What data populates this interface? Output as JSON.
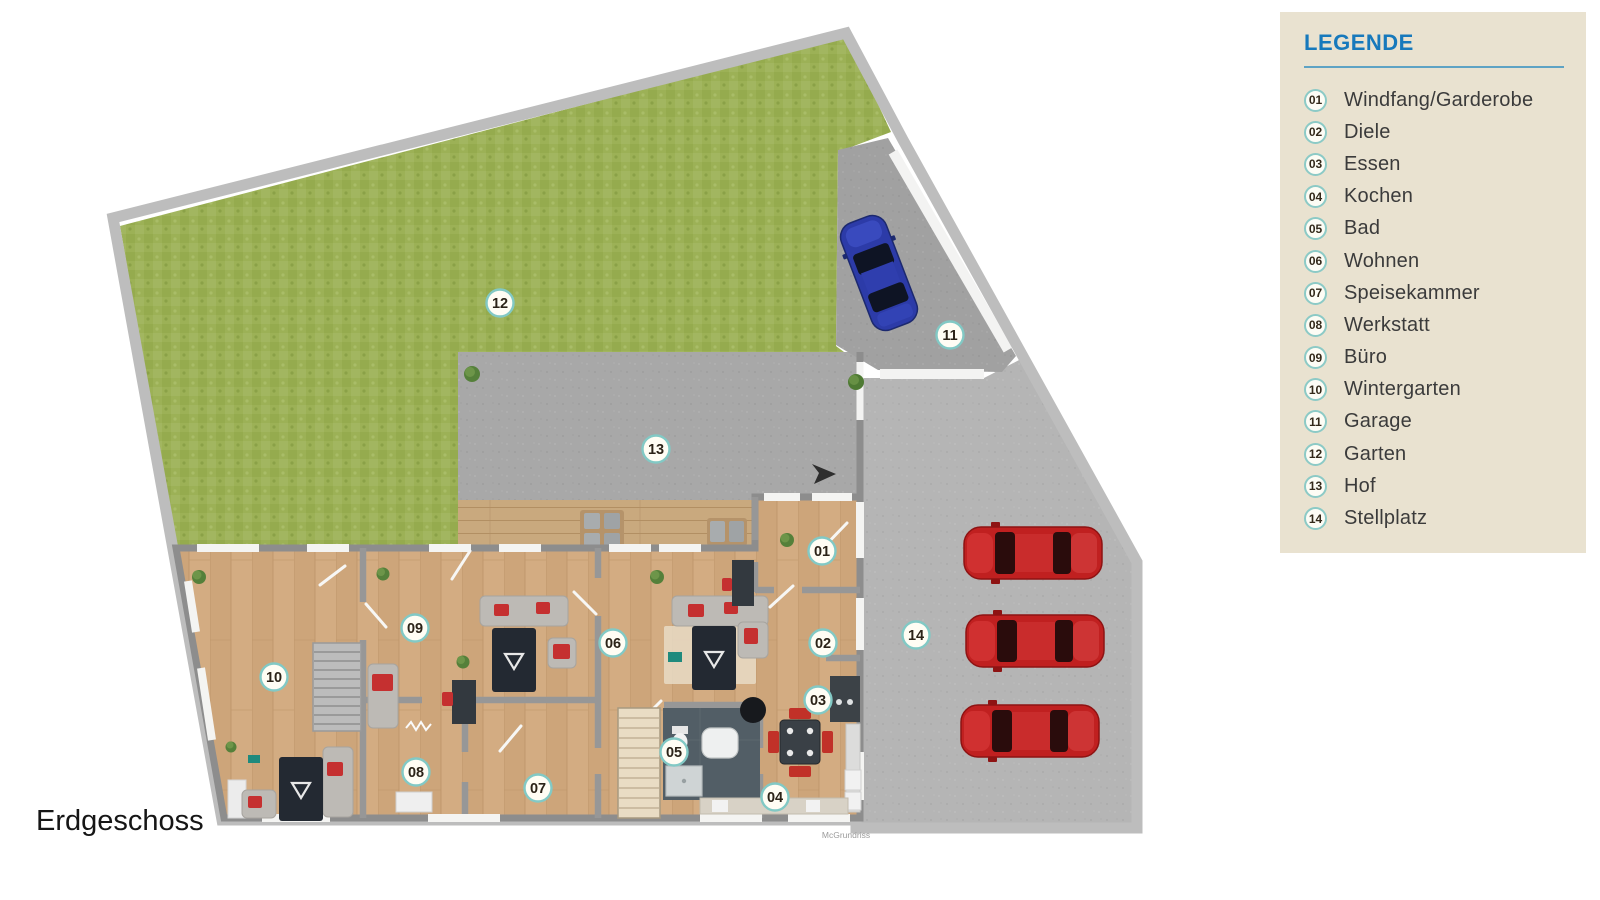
{
  "floor_label": "Erdgeschoss",
  "watermark": "McGrundriss",
  "legend": {
    "title": "LEGENDE",
    "items": [
      {
        "num": "01",
        "label": "Windfang/Garderobe"
      },
      {
        "num": "02",
        "label": "Diele"
      },
      {
        "num": "03",
        "label": "Essen"
      },
      {
        "num": "04",
        "label": "Kochen"
      },
      {
        "num": "05",
        "label": "Bad"
      },
      {
        "num": "06",
        "label": "Wohnen"
      },
      {
        "num": "07",
        "label": "Speisekammer"
      },
      {
        "num": "08",
        "label": "Werkstatt"
      },
      {
        "num": "09",
        "label": "Büro"
      },
      {
        "num": "10",
        "label": "Wintergarten"
      },
      {
        "num": "11",
        "label": "Garage"
      },
      {
        "num": "12",
        "label": "Garten"
      },
      {
        "num": "13",
        "label": "Hof"
      },
      {
        "num": "14",
        "label": "Stellplatz"
      }
    ]
  },
  "floor_plan": {
    "badges": [
      {
        "num": "01",
        "x": 822,
        "y": 551
      },
      {
        "num": "02",
        "x": 823,
        "y": 643
      },
      {
        "num": "03",
        "x": 818,
        "y": 700
      },
      {
        "num": "04",
        "x": 775,
        "y": 797
      },
      {
        "num": "05",
        "x": 674,
        "y": 752
      },
      {
        "num": "06",
        "x": 613,
        "y": 643
      },
      {
        "num": "07",
        "x": 538,
        "y": 788
      },
      {
        "num": "08",
        "x": 416,
        "y": 772
      },
      {
        "num": "09",
        "x": 415,
        "y": 628
      },
      {
        "num": "10",
        "x": 274,
        "y": 677
      },
      {
        "num": "11",
        "x": 950,
        "y": 335
      },
      {
        "num": "12",
        "x": 500,
        "y": 303
      },
      {
        "num": "13",
        "x": 656,
        "y": 449
      },
      {
        "num": "14",
        "x": 916,
        "y": 635
      }
    ]
  },
  "colors": {
    "legend_bg": "#e9e2d0",
    "accent_blue": "#1779bc",
    "legend_rule": "#5ea3c4",
    "badge_ring": "#82c9c5",
    "grass_green": "#9cb156",
    "asphalt_gray": "#b5b5b5",
    "wood_tan": "#d3ac82",
    "boundary_gray": "#bdbdbd",
    "car_red": "#c02020",
    "car_blue": "#2c3ba8"
  }
}
